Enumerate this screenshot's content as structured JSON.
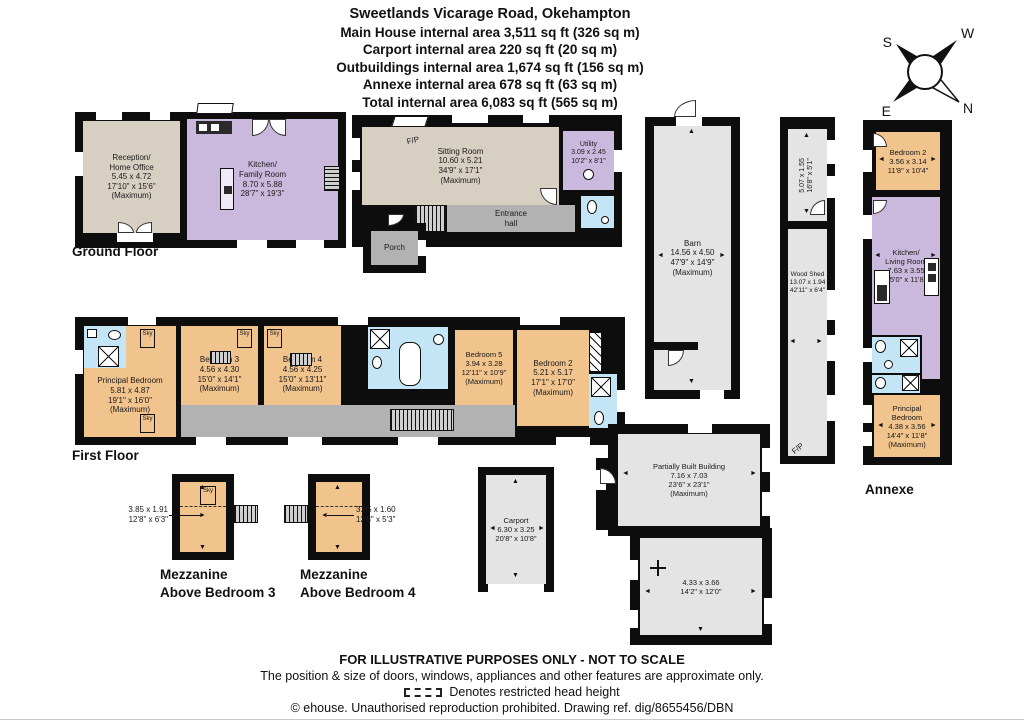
{
  "title": {
    "address": "Sweetlands Vicarage Road, Okehampton",
    "main_house": "Main House internal area 3,511 sq ft (326 sq m)",
    "carport": "Carport internal area 220 sq ft (20 sq m)",
    "outbuildings": "Outbuildings internal area 1,674 sq ft (156 sq m)",
    "annexe": "Annexe internal area 678 sq ft (63 sq m)",
    "total": "Total internal area 6,083 sq ft (565 sq m)"
  },
  "compass": {
    "n": "N",
    "s": "S",
    "e": "E",
    "w": "W"
  },
  "labels": {
    "ground_floor": "Ground Floor",
    "first_floor": "First Floor",
    "annexe": "Annexe",
    "mezzanine3": "Mezzanine\nAbove Bedroom 3",
    "mezzanine4": "Mezzanine\nAbove Bedroom 4"
  },
  "ground": {
    "reception": "Reception/\nHome Office\n5.45 x 4.72\n17'10\" x 15'6\"\n(Maximum)",
    "kitchen": "Kitchen/\nFamily Room\n8.70 x 5.88\n28'7\" x 19'3\"",
    "sitting": "Sitting Room\n10.60 x 5.21\n34'9\" x 17'1\"\n(Maximum)",
    "fireplace": "F/P",
    "utility": "Utility\n3.09 x 2.45\n10'2\" x 8'1\"",
    "entrance": "Entrance\nhall",
    "porch": "Porch"
  },
  "first": {
    "principal": "Principal Bedroom\n5.81 x 4.87\n19'1\" x 16'0\"\n(Maximum)",
    "bedroom3": "Bedroom 3\n4.56 x 4.30\n15'0\" x 14'1\"\n(Maximum)",
    "bedroom4": "Bedroom 4\n4.56 x 4.25\n15'0\" x 13'11\"\n(Maximum)",
    "bedroom5": "Bedroom 5\n3.94 x 3.28\n12'11\" x 10'9\"\n(Maximum)",
    "bedroom2": "Bedroom 2\n5.21 x 5.17\n17'1\" x 17'0\"\n(Maximum)",
    "sky": "Sky"
  },
  "outbuildings": {
    "barn": "Barn\n14.56 x 4.50\n47'9\" x 14'9\"\n(Maximum)",
    "store": "5.07 x 1.55\n16'8\" x 5'1\"",
    "woodshed": "Wood Shed\n13.07 x 1.94\n42'11\" x 6'4\"",
    "fireplace": "F/P",
    "carport": "Carport\n6.30 x 3.25\n20'8\" x 10'8\"",
    "partially_built": "Partially Built Building\n7.16 x 7.03\n23'6\" x 23'1\"\n(Maximum)",
    "partially_built_lower": "4.33 x 3.66\n14'2\" x 12'0\""
  },
  "annexe": {
    "bedroom2": "Bedroom 2\n3.56 x 3.14\n11'8\" x 10'4\"",
    "kitchen_living": "Kitchen/\nLiving Room\n7.63 x 3.55\n25'0\" x 11'8\"",
    "principal": "Principal\nBedroom\n4.38 x 3.56\n14'4\" x 11'8\"\n(Maximum)"
  },
  "mezzanine": {
    "m3_dims": "3.85 x 1.91\n12'8\" x 6'3\"",
    "m4_dims": "3.85 x 1.60\n12'8\" x 5'3\""
  },
  "footer": {
    "line1": "FOR ILLUSTRATIVE PURPOSES ONLY - NOT TO SCALE",
    "line2": "The position & size of doors, windows, appliances and other features are approximate only.",
    "line3": "Denotes restricted head height",
    "line4": "© ehouse. Unauthorised reproduction prohibited. Drawing ref. dig/8655456/DBN"
  },
  "icons": {
    "arrow_up": "▲",
    "arrow_down": "▼",
    "arrow_left": "◄",
    "arrow_right": "►"
  },
  "colors": {
    "wall": "#0d0d0d",
    "beige": "#d7cfc2",
    "purple": "#cbb9dd",
    "orange": "#f1c38d",
    "blue": "#c3e5f5",
    "hall_gray": "#b2b2b2",
    "outbuilding_gray": "#e4e4e4"
  }
}
